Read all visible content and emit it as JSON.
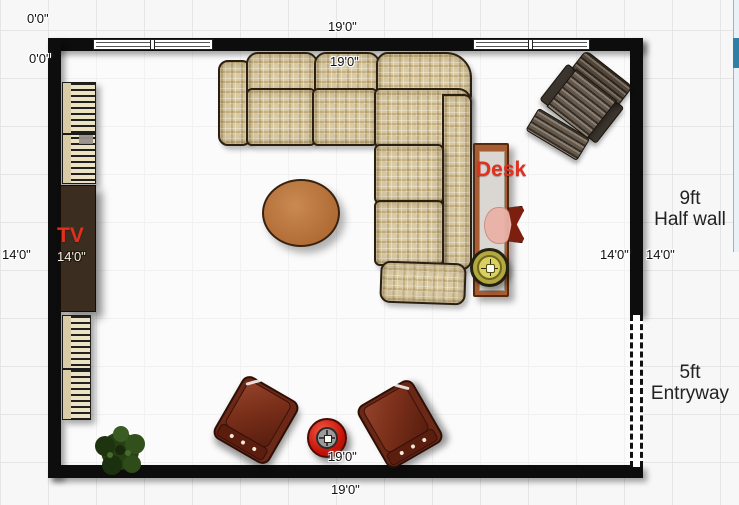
{
  "canvas": {
    "type": "floor-plan"
  },
  "room": {
    "dimensions": {
      "origin_top": "0'0\"",
      "origin_left": "0'0\"",
      "top_outside": "19'0\"",
      "top_inside": "19'0\"",
      "bottom_inside": "19'0\"",
      "bottom_outside": "19'0\"",
      "left_outside": "14'0\"",
      "left_inside": "14'0\"",
      "right_inside": "14'0\"",
      "right_outside": "14'0\""
    },
    "features": {
      "half_wall": {
        "size": "9ft",
        "label": "Half wall"
      },
      "entryway": {
        "size": "5ft",
        "label": "Entryway"
      }
    },
    "item_labels": {
      "tv": "TV",
      "desk": "Desk"
    },
    "furniture_items": [
      "sectional-sofa",
      "coffee-table",
      "tv-cabinet",
      "shelf-unit-upper",
      "shelf-unit-lower",
      "desk",
      "desk-chair",
      "table-lamp",
      "recliner-with-ottoman",
      "armchair-left",
      "armchair-right",
      "subwoofer-speaker",
      "potted-plant",
      "window",
      "entry-opening"
    ]
  },
  "colors": {
    "wall": "#0d0d0d",
    "sofa_plaid": "#d9caa2",
    "coffee_table": "#b06a34",
    "armchair_brown": "#6b2817",
    "desk_frame": "#a85c32",
    "annotation_red": "#e0301e",
    "speaker_red": "#c71408",
    "plant_green": "#2a4517",
    "lamp_olive": "#b3a83e",
    "scroll_thumb_blue": "#2f80a7"
  }
}
